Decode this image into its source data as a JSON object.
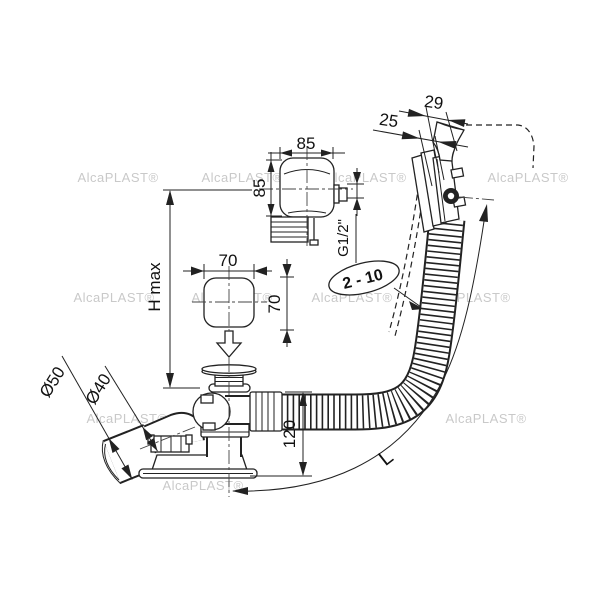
{
  "drawing": {
    "type": "technical-line-drawing",
    "subject": "bath waste and overflow drain set with remote control knob, corrugated hose and elbow outlet"
  },
  "labels": {
    "dim_knob_width": "85",
    "dim_knob_height": "85",
    "dim_small_knob_width": "70",
    "dim_small_knob_height": "70",
    "dim_h_max": "H max",
    "dim_thread": "G1/2\"",
    "dim_wall_range": "2 - 10",
    "dim_overflow_29": "29",
    "dim_overflow_25": "25",
    "dia_outer_sleeve": "Ø50",
    "dia_inner_pipe": "Ø40",
    "dim_drain_height": "120",
    "dim_hose_length": "L"
  },
  "watermark": {
    "text": "AlcaPLAST®"
  },
  "colors": {
    "line": "#222222",
    "background": "#ffffff",
    "watermark": "#c9c9c9"
  }
}
